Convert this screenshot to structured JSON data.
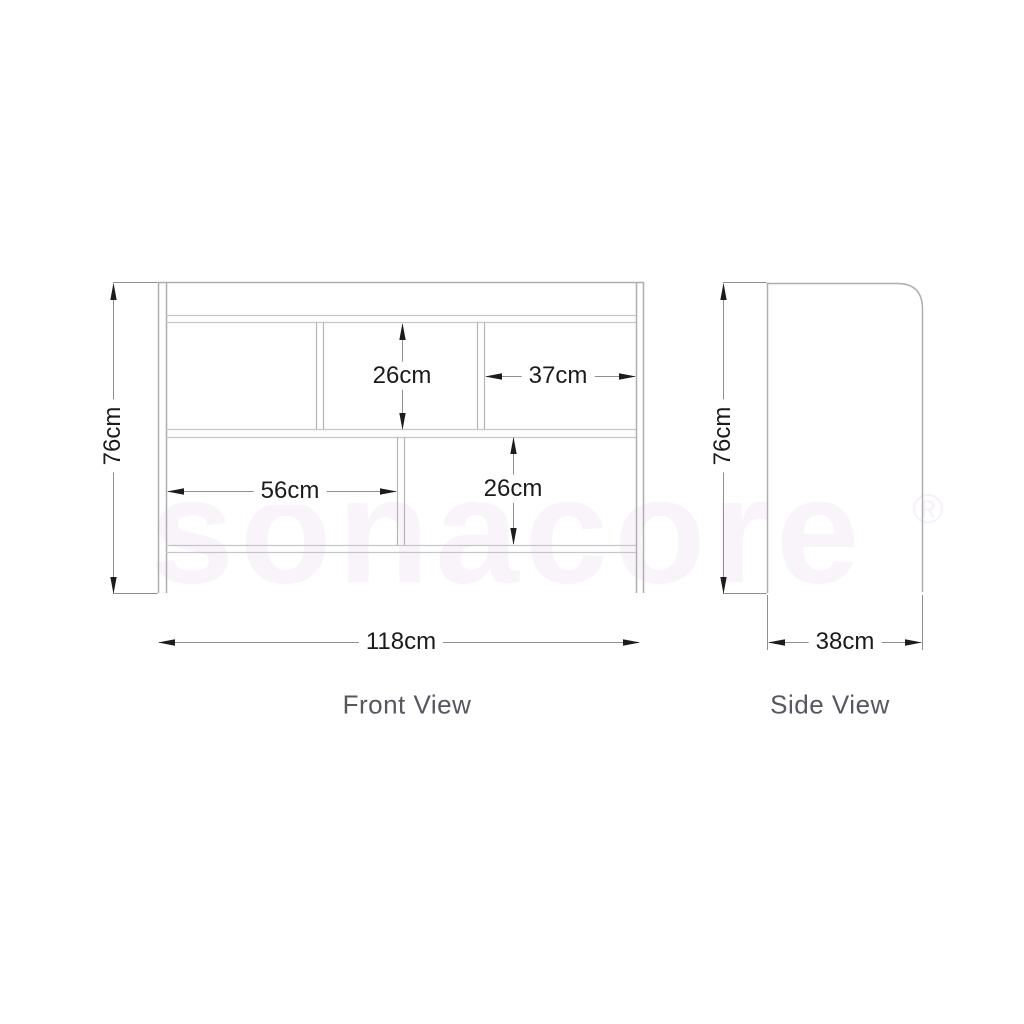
{
  "watermark": {
    "brand": "sonacore",
    "registered_mark": "®"
  },
  "front_view": {
    "title": "Front View",
    "dimensions": {
      "overall_height": "76cm",
      "overall_width": "118cm",
      "upper_compartment_height": "26cm",
      "upper_right_compartment_width": "37cm",
      "lower_left_compartment_width": "56cm",
      "lower_compartment_height": "26cm"
    }
  },
  "side_view": {
    "title": "Side View",
    "dimensions": {
      "overall_height": "76cm",
      "overall_depth": "38cm"
    }
  },
  "colors": {
    "panel_line": "#aeaeb0",
    "shelf_line": "#c6c6c8",
    "dimension_line": "#8f8f91",
    "dimension_text": "#1b1b1d",
    "view_label_text": "#56575f",
    "watermark": "#f8f4fa"
  }
}
